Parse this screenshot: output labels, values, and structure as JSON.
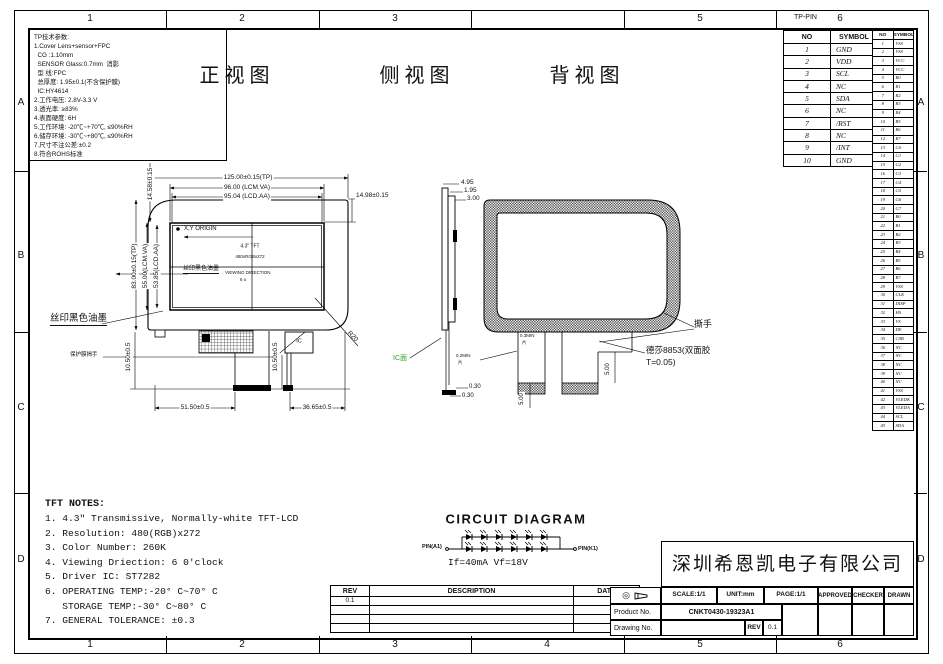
{
  "border": {
    "top_zones": [
      "1",
      "2",
      "3",
      "",
      "5",
      "6"
    ],
    "bottom_zones": [
      "1",
      "2",
      "3",
      "4",
      "5",
      "6"
    ],
    "row_letters": [
      "A",
      "B",
      "C",
      "D"
    ],
    "tp_pin_label": "TP-PIN"
  },
  "tp_notes": {
    "lines": [
      "TP技术参数:",
      "1.Cover Lens+sensor+FPC",
      "  CG :1.10mm",
      "  SENSOR Glass:0.7mm  消影",
      "  型 线:FPC",
      "  总厚度: 1.95±0.1(不含保护膜)",
      "  IC:HY4614",
      "2.工作电压: 2.8V-3.3 V",
      "3.透光率: ≥83%",
      "4.表面硬度: 6H",
      "5.工作环境: -20℃~+70℃, ≤90%RH",
      "6.储存环境: -30℃~+80℃, ≤90%RH",
      "7.尺寸不注公差:±0.2",
      "8.符合ROHS标准"
    ]
  },
  "views": {
    "front_title": "正视图",
    "side_title": "侧视图",
    "back_title": "背视图"
  },
  "tp_pin_table": {
    "headers": [
      "NO",
      "SYMBOL"
    ],
    "rows": [
      [
        "1",
        "GND"
      ],
      [
        "2",
        "VDD"
      ],
      [
        "3",
        "SCL"
      ],
      [
        "4",
        "NC"
      ],
      [
        "5",
        "SDA"
      ],
      [
        "6",
        "NC"
      ],
      [
        "7",
        "/RST"
      ],
      [
        "8",
        "NC"
      ],
      [
        "9",
        "/INT"
      ],
      [
        "10",
        "GND"
      ]
    ]
  },
  "lcd_pin_table": {
    "headers": [
      "NO",
      "SYMBOL"
    ],
    "rows": [
      [
        "1",
        "VSS"
      ],
      [
        "2",
        "VSS"
      ],
      [
        "3",
        "VCC"
      ],
      [
        "4",
        "VCC"
      ],
      [
        "5",
        "R0"
      ],
      [
        "6",
        "R1"
      ],
      [
        "7",
        "R2"
      ],
      [
        "8",
        "R3"
      ],
      [
        "9",
        "R4"
      ],
      [
        "10",
        "R5"
      ],
      [
        "11",
        "R6"
      ],
      [
        "12",
        "R7"
      ],
      [
        "13",
        "G0"
      ],
      [
        "14",
        "G1"
      ],
      [
        "15",
        "G2"
      ],
      [
        "16",
        "G3"
      ],
      [
        "17",
        "G4"
      ],
      [
        "18",
        "G5"
      ],
      [
        "19",
        "G6"
      ],
      [
        "20",
        "G7"
      ],
      [
        "21",
        "B0"
      ],
      [
        "22",
        "B1"
      ],
      [
        "23",
        "B2"
      ],
      [
        "24",
        "B3"
      ],
      [
        "25",
        "B4"
      ],
      [
        "26",
        "B5"
      ],
      [
        "27",
        "B6"
      ],
      [
        "28",
        "B7"
      ],
      [
        "29",
        "VSS"
      ],
      [
        "30",
        "CLK"
      ],
      [
        "31",
        "DISP"
      ],
      [
        "32",
        "HS"
      ],
      [
        "33",
        "VS"
      ],
      [
        "34",
        "DE"
      ],
      [
        "35",
        "CSB"
      ],
      [
        "36",
        "NC"
      ],
      [
        "37",
        "NC"
      ],
      [
        "38",
        "NC"
      ],
      [
        "39",
        "NC"
      ],
      [
        "40",
        "NC"
      ],
      [
        "41",
        "VSS"
      ],
      [
        "42",
        "VLEDK"
      ],
      [
        "43",
        "VLEDA"
      ],
      [
        "44",
        "SCL"
      ],
      [
        "45",
        "SDA"
      ]
    ]
  },
  "front_view": {
    "dim_w_tp": "125.00±0.15(TP)",
    "dim_w_va": "96.00 (LCM.VA)",
    "dim_w_aa": "95.04 (LCD.AA)",
    "dim_left_top": "14.58±0.15",
    "dim_right_top": "14.98±0.15",
    "dim_h_tp": "83.00±0.15(TP)",
    "dim_h_va": "55.00(LCM.VA)",
    "dim_h_aa": "53.85(LCD.AA)",
    "origin": "X,Y ORIGIN",
    "panel": "4.3\" TFT",
    "resolution": "480xRGBx272",
    "silk_inner": "丝印黑色油墨",
    "view_dir": "VIEWING DIRECTION",
    "view_dir2": "6 o",
    "silk_outer": "丝印黑色油墨",
    "film_tab": "保护膜揭手",
    "ic": "IC",
    "dim_fpc_h": "10.50±0.5",
    "dim_ic_h": "10.50±0.5",
    "dim_fpc_x": "51.50±0.5",
    "dim_ic_x": "36.65±0.5",
    "r20": "R20"
  },
  "side_view": {
    "dim_total": "4.95",
    "dim_mid": "1.95",
    "dim_lcm": "3.00",
    "ic_side": "IC面",
    "dim_foot1": "0.30",
    "dim_foot2": "0.30"
  },
  "back_view": {
    "tear": "撕手",
    "tape1": "德莎8853(双面胶",
    "tape2": "T=0.05)",
    "min_left": "0.2MIN",
    "min_left2": "片",
    "min_mid": "0.3MIN",
    "min_mid2": "片",
    "tab_h1": "5.00",
    "tab_h2": "5.00"
  },
  "circuit": {
    "title": "CIRCUIT DIAGRAM",
    "pin_left": "PIN(A1)",
    "pin_right": "PIN(K1)",
    "spec": "If=40mA Vf=18V"
  },
  "tft_notes": {
    "title": "TFT NOTES:",
    "lines": [
      "1. 4.3″ Transmissive, Normally-white TFT-LCD",
      "2. Resolution: 480(RGB)x272",
      "3. Color Number: 260K",
      "4. Viewing Driection: 6 0'clock",
      "5. Driver IC: ST7282",
      "6. OPERATING TEMP:-20° C~70° C",
      "   STORAGE TEMP:-30° C~80° C",
      "7. GENERAL TOLERANCE: ±0.3"
    ]
  },
  "revision_table": {
    "headers": [
      "REV",
      "DESCRIPTION",
      "DATE"
    ],
    "rows": [
      [
        "0.1",
        "",
        ""
      ],
      [
        "",
        "",
        ""
      ],
      [
        "",
        "",
        ""
      ],
      [
        "",
        "",
        ""
      ]
    ]
  },
  "title_block": {
    "company": "深圳希恩凯电子有限公司",
    "scale": "SCALE:1/1",
    "unit": "UNIT:mm",
    "page": "PAGE:1/1",
    "approved": "APPROVED",
    "checker": "CHECKER",
    "drawn": "DRAWN",
    "product_label": "Product No.",
    "product_no": "CNKT0430-19323A1",
    "drawing_label": "Drawing No.",
    "rev_label": "REV",
    "rev_value": "0.1"
  }
}
